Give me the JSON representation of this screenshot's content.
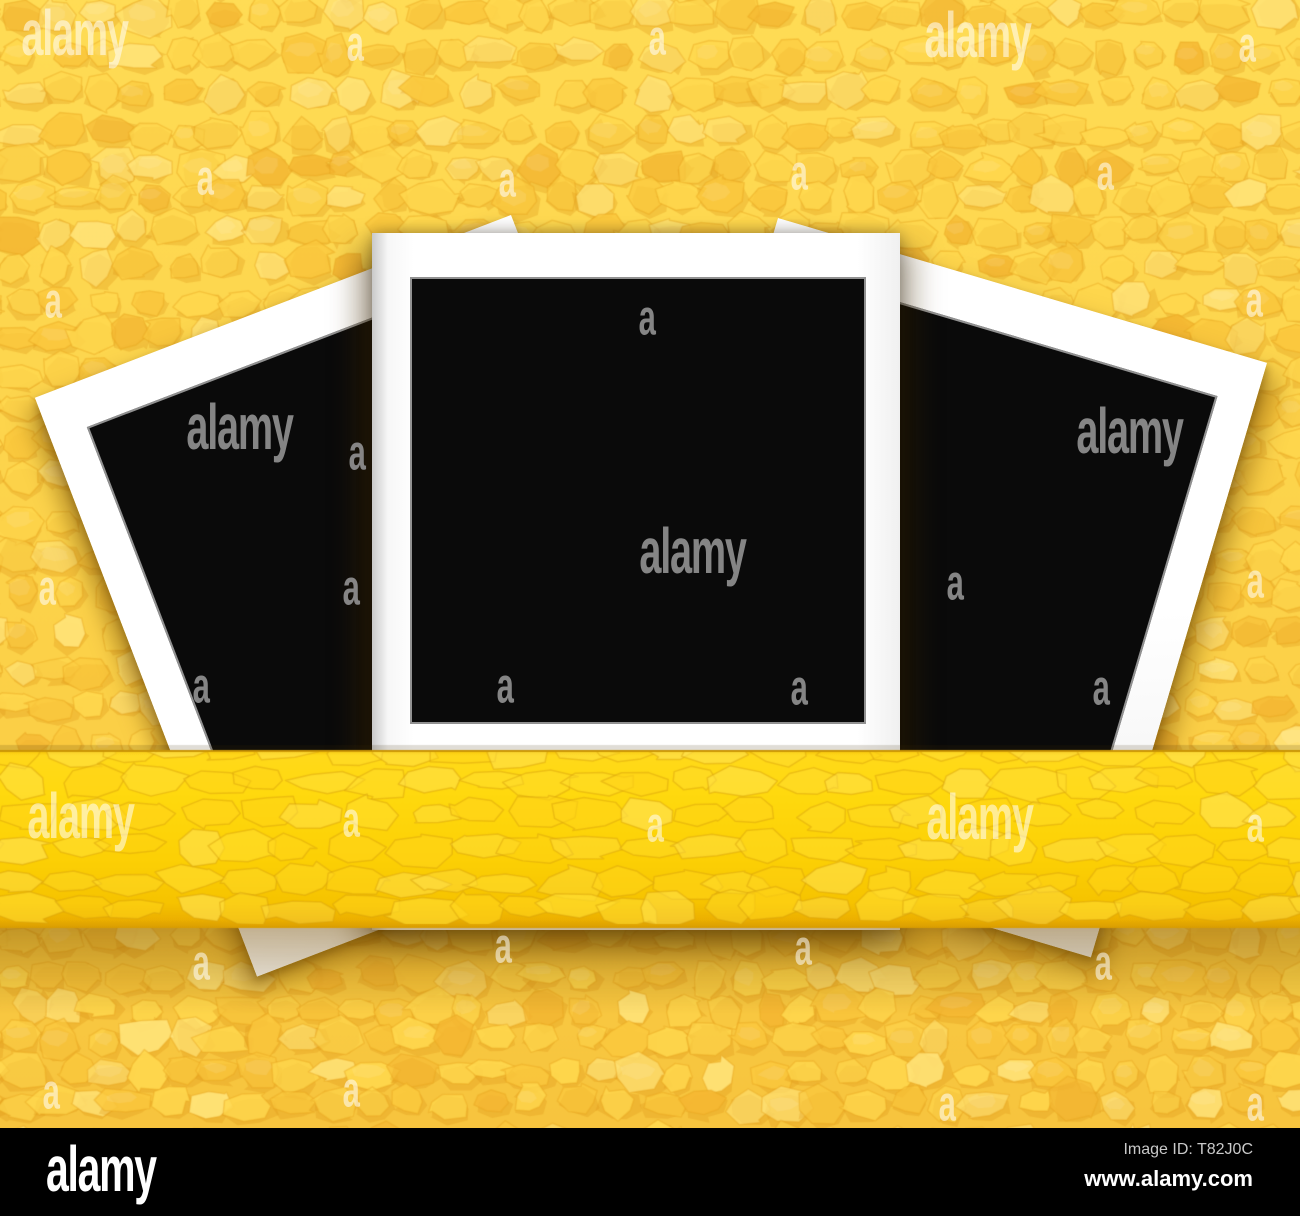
{
  "page": {
    "width": 1300,
    "height": 1216
  },
  "colors": {
    "bg_top": "#ffdc55",
    "bg_mid": "#fcd148",
    "bg_bottom": "#f6c23c",
    "cell_light": "#ffe377",
    "cell_mid": "#ffd84e",
    "cell_deep": "#fbc93e",
    "cell_orange": "#f5b833",
    "cell_shade": "rgba(223,150,22,0.30)",
    "cell_gap": "rgba(233,164,30,0.40)",
    "ribbon_stops": [
      [
        0,
        "#f1bb04"
      ],
      [
        0.03,
        "#ffd91a"
      ],
      [
        0.25,
        "#ffd90e"
      ],
      [
        0.62,
        "#fcd005"
      ],
      [
        0.86,
        "#f6c300"
      ],
      [
        0.95,
        "#edb100"
      ],
      [
        1,
        "#d89c02"
      ]
    ],
    "ribbon_cells": [
      "#ffe14e",
      "#ffdc2e",
      "#ffd41a"
    ],
    "ribbon_gap": "rgba(214,160,10,0.45)",
    "ribbon_top_line": "rgba(150,95,0,0.45)",
    "ribbon_shadow": "rgba(120,78,0,0.42)",
    "frame_white": "#ffffff",
    "photo_black": "#0a0a0a",
    "bar_bg": "#000000",
    "bar_dim_text": "#c9c9c9",
    "bar_text": "#ffffff",
    "wm_light": "rgba(255,255,255,0.55)",
    "wm_dark": "rgba(140,140,140,0.95)"
  },
  "ribbon": {
    "top": 750,
    "bottom": 928,
    "shadow_end": 1014
  },
  "watermarks": {
    "word_text": "alamy",
    "letter_text": "a",
    "items": [
      {
        "x": 42,
        "y": 36,
        "type": "word",
        "tone": "L"
      },
      {
        "x": 350,
        "y": 46,
        "type": "letter",
        "tone": "L"
      },
      {
        "x": 652,
        "y": 40,
        "type": "letter",
        "tone": "L"
      },
      {
        "x": 945,
        "y": 38,
        "type": "word",
        "tone": "L"
      },
      {
        "x": 1242,
        "y": 47,
        "type": "letter",
        "tone": "L"
      },
      {
        "x": 200,
        "y": 180,
        "type": "letter",
        "tone": "L"
      },
      {
        "x": 502,
        "y": 182,
        "type": "letter",
        "tone": "L"
      },
      {
        "x": 794,
        "y": 175,
        "type": "letter",
        "tone": "L"
      },
      {
        "x": 1100,
        "y": 175,
        "type": "letter",
        "tone": "L"
      },
      {
        "x": 48,
        "y": 303,
        "type": "letter",
        "tone": "L"
      },
      {
        "x": 642,
        "y": 320,
        "type": "letter",
        "tone": "D"
      },
      {
        "x": 1249,
        "y": 302,
        "type": "letter",
        "tone": "L"
      },
      {
        "x": 207,
        "y": 430,
        "type": "word",
        "tone": "D"
      },
      {
        "x": 352,
        "y": 455,
        "type": "letter",
        "tone": "D"
      },
      {
        "x": 1097,
        "y": 434,
        "type": "word",
        "tone": "D"
      },
      {
        "x": 42,
        "y": 590,
        "type": "letter",
        "tone": "L"
      },
      {
        "x": 346,
        "y": 590,
        "type": "letter",
        "tone": "D"
      },
      {
        "x": 660,
        "y": 554,
        "type": "word",
        "tone": "D"
      },
      {
        "x": 950,
        "y": 585,
        "type": "letter",
        "tone": "D"
      },
      {
        "x": 1250,
        "y": 583,
        "type": "letter",
        "tone": "L"
      },
      {
        "x": 196,
        "y": 688,
        "type": "letter",
        "tone": "D"
      },
      {
        "x": 500,
        "y": 688,
        "type": "letter",
        "tone": "D"
      },
      {
        "x": 794,
        "y": 690,
        "type": "letter",
        "tone": "D"
      },
      {
        "x": 1096,
        "y": 690,
        "type": "letter",
        "tone": "D"
      },
      {
        "x": 48,
        "y": 819,
        "type": "word",
        "tone": "L"
      },
      {
        "x": 346,
        "y": 822,
        "type": "letter",
        "tone": "L"
      },
      {
        "x": 650,
        "y": 827,
        "type": "letter",
        "tone": "L"
      },
      {
        "x": 947,
        "y": 820,
        "type": "word",
        "tone": "L"
      },
      {
        "x": 1250,
        "y": 827,
        "type": "letter",
        "tone": "L"
      },
      {
        "x": 196,
        "y": 965,
        "type": "letter",
        "tone": "L"
      },
      {
        "x": 498,
        "y": 948,
        "type": "letter",
        "tone": "L"
      },
      {
        "x": 798,
        "y": 950,
        "type": "letter",
        "tone": "L"
      },
      {
        "x": 1098,
        "y": 965,
        "type": "letter",
        "tone": "L"
      },
      {
        "x": 46,
        "y": 1094,
        "type": "letter",
        "tone": "L"
      },
      {
        "x": 346,
        "y": 1092,
        "type": "letter",
        "tone": "L"
      },
      {
        "x": 942,
        "y": 1106,
        "type": "letter",
        "tone": "L"
      },
      {
        "x": 1250,
        "y": 1106,
        "type": "letter",
        "tone": "L"
      }
    ]
  },
  "footer": {
    "logo": "alamy",
    "image_id": "Image ID: T82J0C",
    "url": "www.alamy.com"
  }
}
